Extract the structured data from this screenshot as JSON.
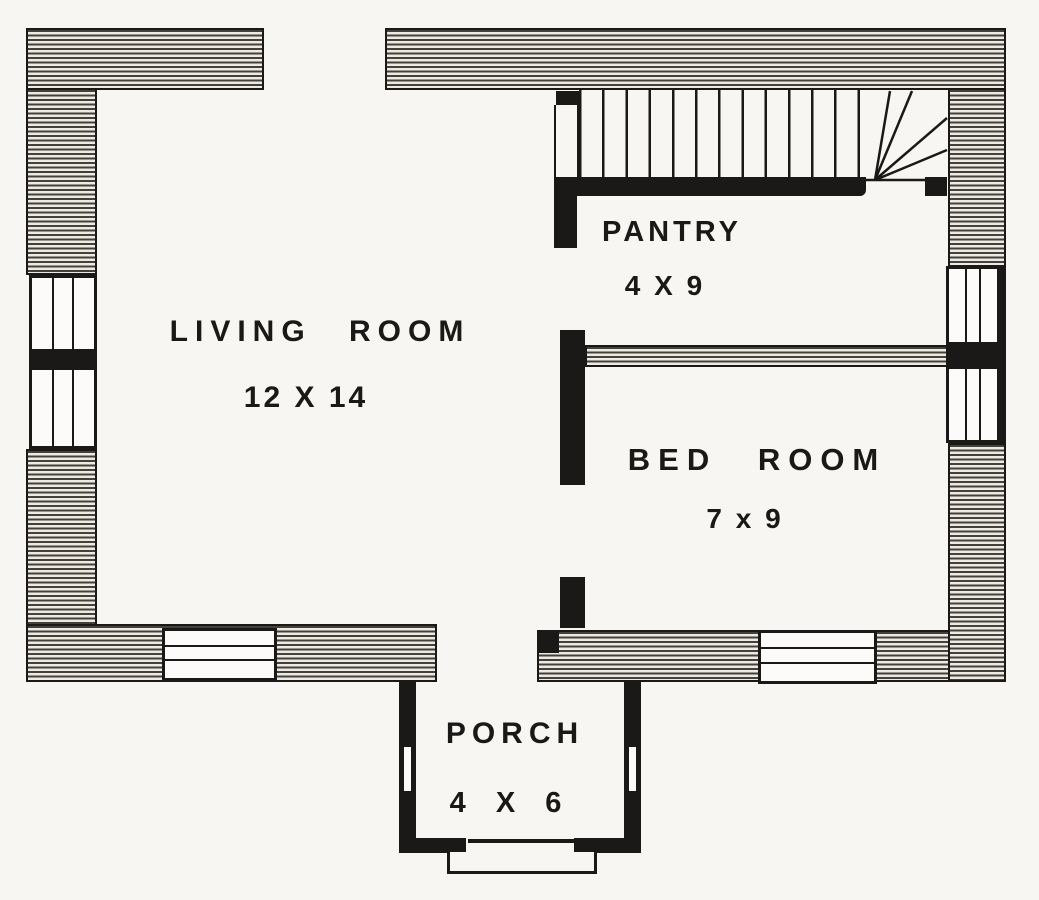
{
  "figure": {
    "type": "floor-plan",
    "floor": "first-floor cottage plan"
  },
  "colors": {
    "ink": "#1b1917",
    "paper": "#f7f6f2",
    "hatch": "#eceae3"
  },
  "rooms": {
    "living_room": {
      "name": "LIVING ROOM",
      "dimensions": "12 X 14"
    },
    "pantry": {
      "name": "PANTRY",
      "dimensions": "4 X 9"
    },
    "bed_room": {
      "name": "BED ROOM",
      "dimensions": "7 x 9"
    },
    "porch": {
      "name": "PORCH",
      "dimensions": "4 X 6"
    }
  }
}
